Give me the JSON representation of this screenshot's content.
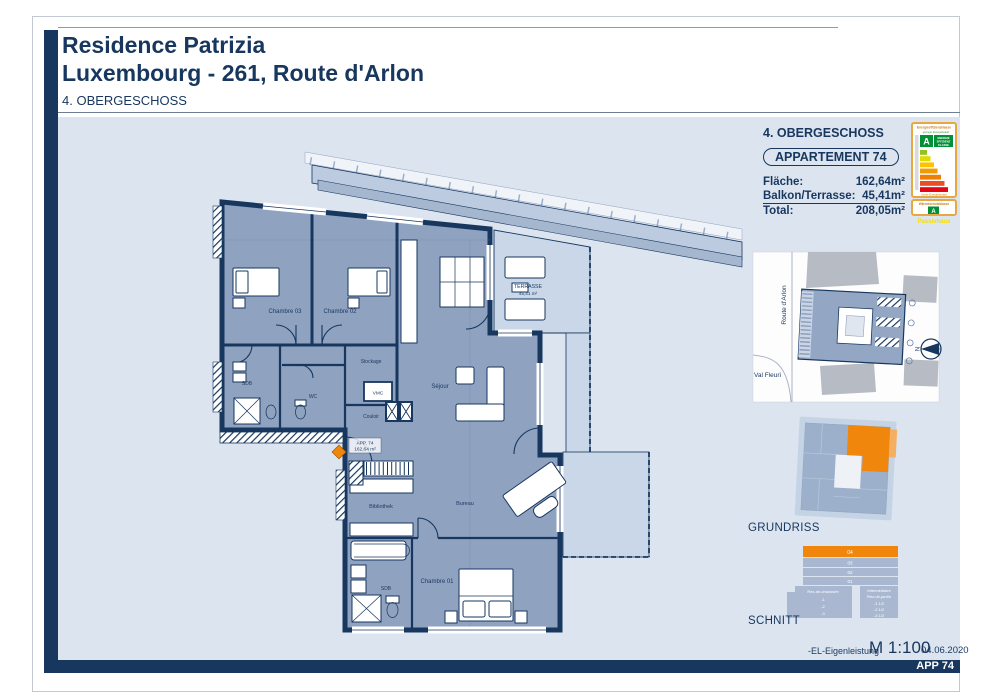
{
  "header": {
    "title_line1": "Residence Patrizia",
    "title_line2": "Luxembourg - 261, Route d'Arlon",
    "subtitle": "4. OBERGESCHOSS"
  },
  "sidebar": {
    "floor_label": "4. OBERGESCHOSS",
    "apartment_badge": "APPARTEMENT 74",
    "area_rows": [
      {
        "label": "Fläche:",
        "value": "162,64m²"
      },
      {
        "label": "Balkon/Terrasse:",
        "value": "45,41m²"
      },
      {
        "label": "Total:",
        "value": "208,05m²"
      }
    ],
    "energy": {
      "box1_title": "Energieeffizienzklasse",
      "low_label": "geringer Energiebedarf",
      "high_label": "hoher Energiebedarf",
      "class_letter": "A",
      "caption_lines": [
        "ENERGIE",
        "EFFIZIENZ",
        "KLASSE"
      ],
      "bar_colors": [
        "#94c11f",
        "#dedc00",
        "#fdc300",
        "#f39a01",
        "#ef7d00",
        "#e94e24",
        "#e30613"
      ],
      "box2_title": "Wärmeschutzklasse",
      "box2_letter": "A",
      "footnote": "Passivhaus"
    },
    "siteplan": {
      "street_left": "Route d'Arlon",
      "street_bottom": "Val Fleuri",
      "compass": "N"
    },
    "grundriss_label": "GRUNDRISS",
    "schnitt_label": "SCHNITT",
    "schnitt": {
      "floors": [
        "04",
        "03",
        "02",
        "01"
      ],
      "left_lines": [
        "Rez-de-chaussée",
        "-1",
        "-2",
        "-3"
      ],
      "right_lines": [
        "Intermédiaire",
        "Rez-de-jardin",
        "-1 1/2",
        "-2 1/2",
        "-3 1/2"
      ]
    }
  },
  "plan": {
    "rooms": {
      "chambre03": "Chambre 03",
      "chambre02": "Chambre 02",
      "stockage": "Stockage",
      "vmc": "VMC",
      "wc": "WC",
      "sdb1": "SDB",
      "couloir": "Couloir",
      "sejour": "Séjour",
      "bibliothek": "Bibliothek",
      "bureau": "Bureau",
      "sdb2": "SDB",
      "chambre01": "Chambre 01"
    },
    "terrace": {
      "line1": "TERRASSE",
      "line2": "45,41 m²"
    },
    "entrance": {
      "line1": "APP. 74",
      "line2": "162,64 m²"
    }
  },
  "footer": {
    "note": "-EL-Eigenleistung",
    "scale": "M 1:100",
    "date": "04.06.2020",
    "bar_label": "APP 74"
  },
  "colors": {
    "navy": "#17375e",
    "floor_fill": "#8fa2c0",
    "terrace_fill": "#c9d7e9",
    "accent_orange": "#f0860b",
    "content_bg": "#dce4f0",
    "energy_green": "#009036"
  }
}
